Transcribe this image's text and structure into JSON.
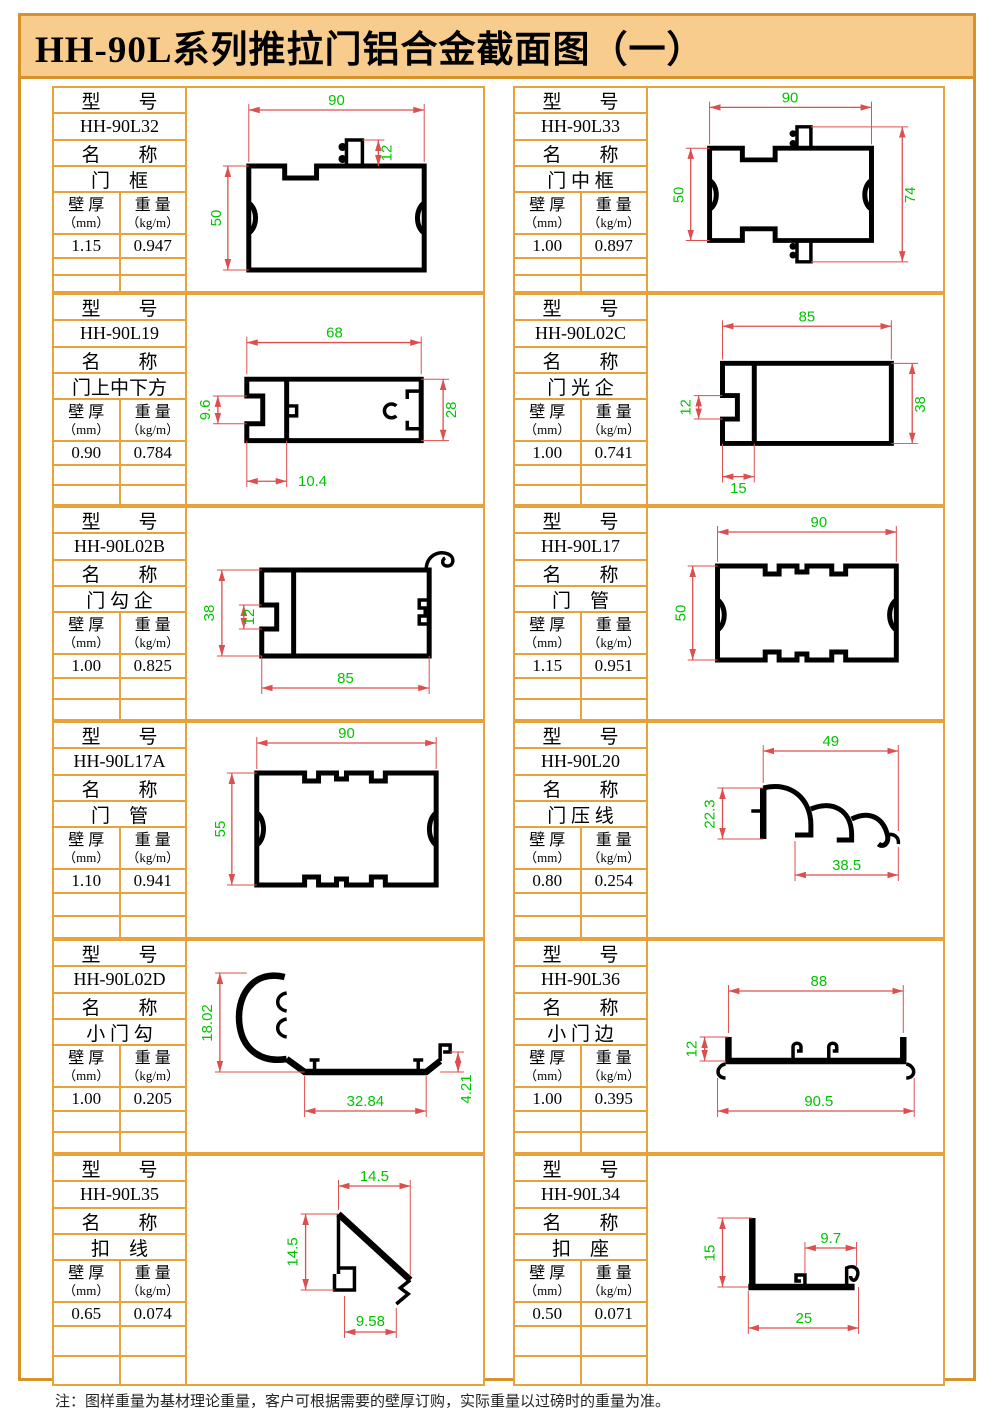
{
  "page": {
    "title": "HH-90L系列推拉门铝合金截面图（一）",
    "footnote": "注：图样重量为基材理论重量，客户可根据需要的壁厚订购，实际重量以过磅时的重量为准。"
  },
  "labels": {
    "model": "型　　号",
    "name": "名　　称",
    "thickness": "壁 厚",
    "thickness_unit": "（mm）",
    "weight": "重 量",
    "weight_unit": "（kg/m）"
  },
  "colors": {
    "border_orange": "#E8A23C",
    "title_bg": "#F8CC8C",
    "dim_line_red": "#DD4F4F",
    "dim_text_green": "#00C400",
    "profile_black": "#000000"
  },
  "cells": [
    {
      "model": "HH-90L32",
      "name": "门　框",
      "thickness": "1.15",
      "weight": "0.947",
      "dims": {
        "d1": "90",
        "d2": "12",
        "d3": "50"
      }
    },
    {
      "model": "HH-90L33",
      "name": "门 中 框",
      "thickness": "1.00",
      "weight": "0.897",
      "dims": {
        "d1": "90",
        "d2": "50",
        "d3": "74"
      }
    },
    {
      "model": "HH-90L19",
      "name": "门上中下方",
      "thickness": "0.90",
      "weight": "0.784",
      "dims": {
        "d1": "68",
        "d2": "9.6",
        "d3": "28",
        "d4": "10.4"
      }
    },
    {
      "model": "HH-90L02C",
      "name": "门 光 企",
      "thickness": "1.00",
      "weight": "0.741",
      "dims": {
        "d1": "85",
        "d2": "12",
        "d3": "38",
        "d4": "15"
      }
    },
    {
      "model": "HH-90L02B",
      "name": "门 勾 企",
      "thickness": "1.00",
      "weight": "0.825",
      "dims": {
        "d1": "38",
        "d2": "12",
        "d3": "85"
      }
    },
    {
      "model": "HH-90L17",
      "name": "门　管",
      "thickness": "1.15",
      "weight": "0.951",
      "dims": {
        "d1": "90",
        "d2": "50"
      }
    },
    {
      "model": "HH-90L17A",
      "name": "门　管",
      "thickness": "1.10",
      "weight": "0.941",
      "dims": {
        "d1": "90",
        "d2": "55"
      }
    },
    {
      "model": "HH-90L20",
      "name": "门 压 线",
      "thickness": "0.80",
      "weight": "0.254",
      "dims": {
        "d1": "49",
        "d2": "22.3",
        "d3": "38.5"
      }
    },
    {
      "model": "HH-90L02D",
      "name": "小 门 勾",
      "thickness": "1.00",
      "weight": "0.205",
      "dims": {
        "d1": "18.02",
        "d2": "32.84",
        "d3": "4.21"
      }
    },
    {
      "model": "HH-90L36",
      "name": "小 门 边",
      "thickness": "1.00",
      "weight": "0.395",
      "dims": {
        "d1": "88",
        "d2": "12",
        "d3": "90.5"
      }
    },
    {
      "model": "HH-90L35",
      "name": "扣　线",
      "thickness": "0.65",
      "weight": "0.074",
      "dims": {
        "d1": "14.5",
        "d2": "14.5",
        "d3": "9.58"
      }
    },
    {
      "model": "HH-90L34",
      "name": "扣　座",
      "thickness": "0.50",
      "weight": "0.071",
      "dims": {
        "d1": "15",
        "d2": "9.7",
        "d3": "25"
      }
    }
  ]
}
